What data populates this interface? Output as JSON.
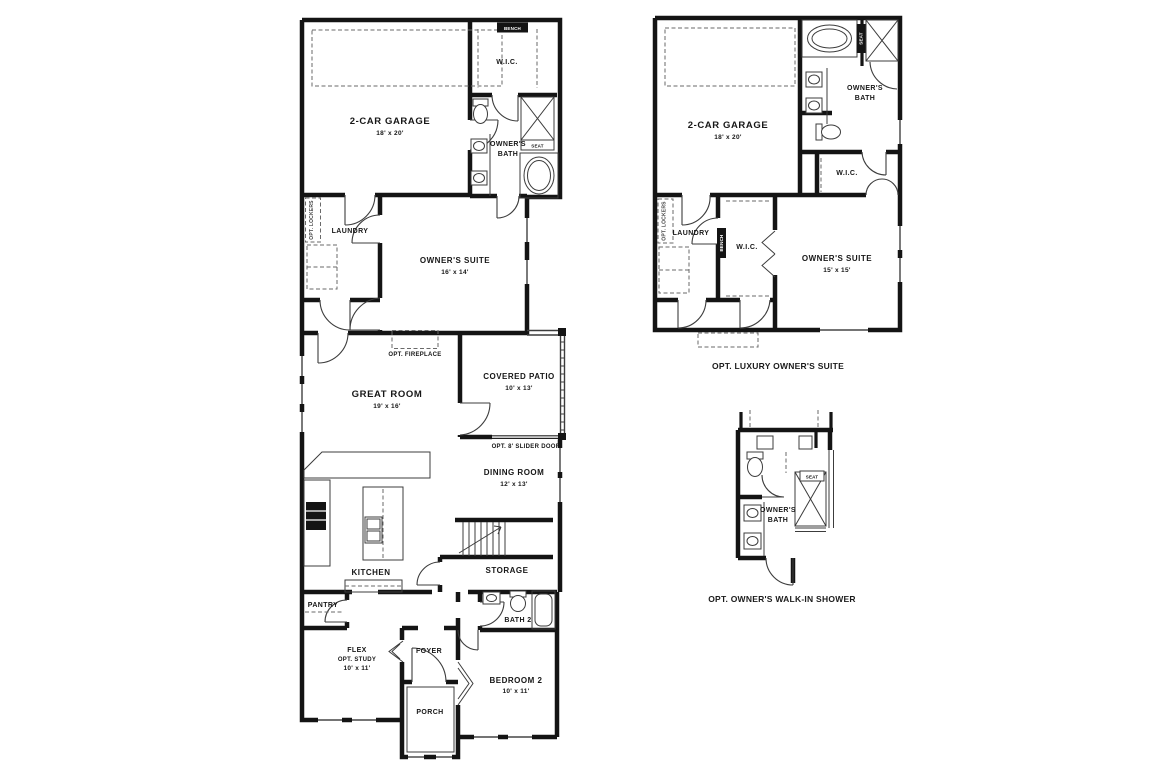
{
  "colors": {
    "wall": "#141414",
    "thin_line": "#3c3c3c",
    "dashed_line": "#6a6a6a",
    "text": "#171717",
    "background": "#ffffff"
  },
  "main_plan": {
    "garage": {
      "name": "2-CAR GARAGE",
      "dims": "18' x 20'"
    },
    "wic": "W.I.C.",
    "bench": "BENCH",
    "owners_bath": {
      "line1": "OWNER'S",
      "line2": "BATH"
    },
    "seat": "SEAT",
    "opt_lockers": "OPT. LOCKERS",
    "laundry": "LAUNDRY",
    "owners_suite": {
      "name": "OWNER'S SUITE",
      "dims": "16' x 14'"
    },
    "opt_fireplace": "OPT. FIREPLACE",
    "great_room": {
      "name": "GREAT ROOM",
      "dims": "19' x 16'"
    },
    "covered_patio": {
      "name": "COVERED PATIO",
      "dims": "10' x 13'"
    },
    "opt_slider_door": "OPT. 8' SLIDER DOOR",
    "dining_room": {
      "name": "DINING ROOM",
      "dims": "12' x 13'"
    },
    "kitchen": "KITCHEN",
    "storage": "STORAGE",
    "pantry": "PANTRY",
    "bath_2": "BATH 2",
    "flex": {
      "name": "FLEX",
      "alt": "OPT. STUDY",
      "dims": "10' x 11'"
    },
    "foyer": "FOYER",
    "porch": "PORCH",
    "bedroom_2": {
      "name": "BEDROOM 2",
      "dims": "10' x 11'"
    }
  },
  "opt_luxury_owners_suite": {
    "caption": "OPT. LUXURY OWNER'S SUITE",
    "garage": {
      "name": "2-CAR GARAGE",
      "dims": "18' x 20'"
    },
    "owners_bath": {
      "line1": "OWNER'S",
      "line2": "BATH"
    },
    "seat": "SEAT",
    "wic_bath": "W.I.C.",
    "opt_lockers": "OPT. LOCKERS",
    "laundry": "LAUNDRY",
    "bench": "BENCH",
    "wic_suite": "W.I.C.",
    "owners_suite": {
      "name": "OWNER'S SUITE",
      "dims": "15' x 15'"
    }
  },
  "opt_walk_in_shower": {
    "caption": "OPT. OWNER'S WALK-IN SHOWER",
    "owners_bath": {
      "line1": "OWNER'S",
      "line2": "BATH"
    },
    "seat": "SEAT"
  }
}
